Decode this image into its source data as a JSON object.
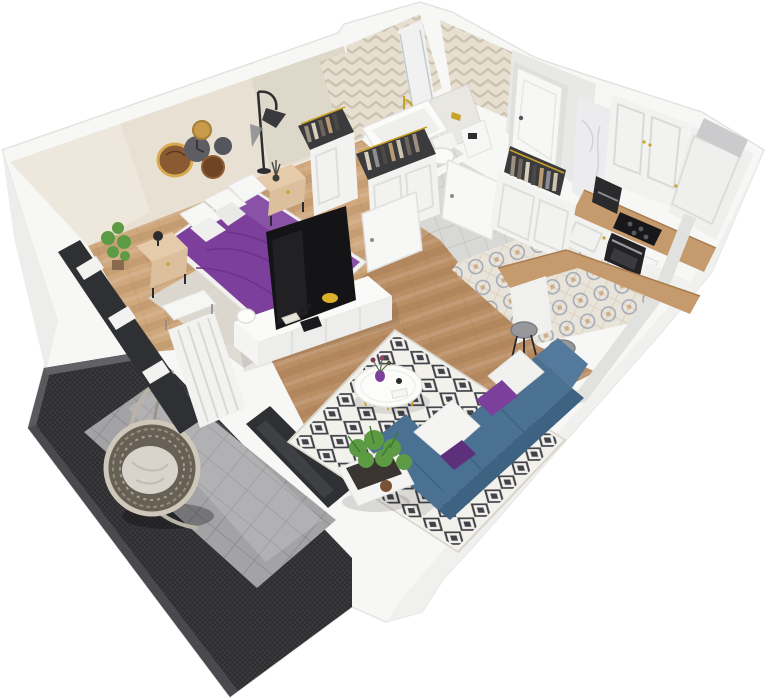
{
  "scene": {
    "type": "isometric-apartment-3d-render",
    "rooms": [
      {
        "id": "bedroom",
        "label": "Bedroom",
        "items": [
          "double bed with purple duvet",
          "white pillows",
          "two wooden nightstands",
          "black table lamp",
          "arc floor lamp",
          "wood-slice wall decor",
          "potted plant",
          "open wardrobes with hanging clothes",
          "white TV console",
          "flat-screen TV",
          "light area rug"
        ]
      },
      {
        "id": "bathroom",
        "label": "Bathroom",
        "items": [
          "bathtub",
          "glass shower screen",
          "gold shower fixture",
          "toilet",
          "tiled cistern with gold flush plate",
          "water heater",
          "herringbone tiled walls"
        ]
      },
      {
        "id": "hallway",
        "label": "Hallway",
        "items": [
          "white entrance door",
          "open closet with hanging clothes",
          "white cabinet",
          "gray tile floor"
        ]
      },
      {
        "id": "kitchen",
        "label": "Kitchen",
        "items": [
          "white framed cabinets",
          "marble backsplash",
          "coffee machine",
          "black cooktop",
          "built-in oven",
          "wooden countertop",
          "white sink",
          "patterned encaustic tile floor",
          "L-shaped wooden bar counter",
          "two gray bar stools",
          "ventilation shaft"
        ]
      },
      {
        "id": "living-room",
        "label": "Living room",
        "items": [
          "blue corner sofa",
          "white and purple cushions",
          "black-and-white diamond rug",
          "round white coffee table",
          "purple vase with flowers",
          "potted ferns in white planter",
          "herringbone parquet floor"
        ]
      },
      {
        "id": "balcony",
        "label": "Balcony",
        "items": [
          "hanging egg chair with cushion",
          "dark mesh railing",
          "gray tile floor",
          "dark glass sliding door"
        ]
      }
    ]
  },
  "colors": {
    "wall_white": "#f7f7f6",
    "wall_edge": "#e0e0dd",
    "bedroom_wall": "#e8e1d3",
    "chevron_base": "#e7e0d1",
    "wood_bedroom": "#cfa87e",
    "wood_living": "#bb8f66",
    "tile_hall": "#d8d8d6",
    "tile_kitchen": "#e8e4da",
    "tile_bath": "#e0dedb",
    "balcony_frame": "#3a3a3d",
    "balcony_floor": "#a3a3a5",
    "duvet_purple": "#7d3f9c",
    "sofa_blue": "#4a7191",
    "sofa_dark": "#3e6382",
    "sofa_light": "#53799c",
    "rug_base": "#f3f1ec",
    "rug_motif": "#42424a",
    "counter_wood": "#c59a6d",
    "tan_furniture": "#e6cbab",
    "gold": "#c9a227",
    "plant_green": "#5c9a43",
    "tv_black": "#141416",
    "glass_dark": "#2e3033",
    "marble": "#ececee",
    "cabinet_white": "#f2f2f1",
    "white_furniture": "#fafaf9"
  }
}
